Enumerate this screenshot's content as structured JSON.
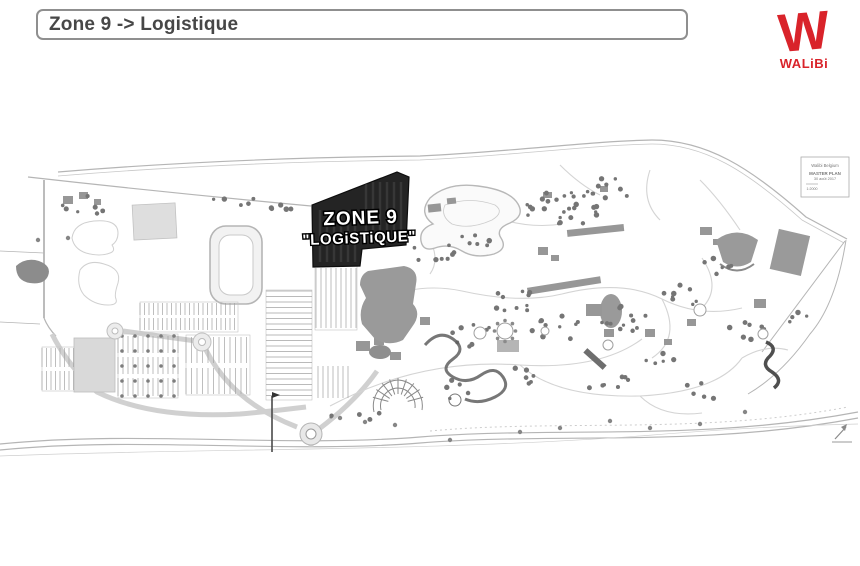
{
  "header": {
    "title": "Zone 9 -> Logistique"
  },
  "logo": {
    "monogram": "W",
    "brand": "WALiBi",
    "color": "#d9232a"
  },
  "map": {
    "zone_label": {
      "line1": "ZONE 9",
      "line2": "\"LOGiSTiQUE\""
    },
    "legend_box": {
      "line1": "Walibi Belgium",
      "line2": "MASTER PLAN",
      "line3": "30 août 2017",
      "line4": "1:2000"
    },
    "colors": {
      "zone_fill": "#242424",
      "zone_edge": "#0d0d0d",
      "line": "#b5b5b5",
      "building": "#979797",
      "tree": "#757575"
    }
  }
}
